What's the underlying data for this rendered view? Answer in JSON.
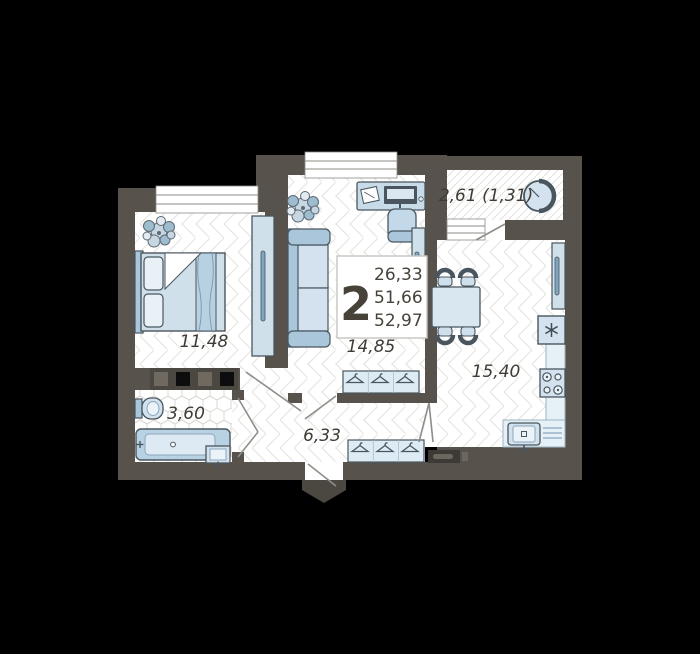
{
  "colors": {
    "background": "#000000",
    "wall": "#57534c",
    "floor": "#ffffff",
    "furniture_light": "#d3e2ee",
    "furniture_mid": "#a9c6da",
    "furniture_deep": "#7fa6c0",
    "outline": "#49565f",
    "label_text": "#3f3b35"
  },
  "summary": {
    "rooms_count": "2",
    "area_lines": [
      "26,33",
      "51,66",
      "52,97"
    ]
  },
  "rooms": [
    {
      "name": "bedroom",
      "area": "11,48"
    },
    {
      "name": "living-room",
      "area": "14,85"
    },
    {
      "name": "kitchen-living",
      "area": "15,40"
    },
    {
      "name": "bathroom",
      "area": "3,60"
    },
    {
      "name": "hallway",
      "area": "6,33"
    },
    {
      "name": "balcony",
      "area": "2,61 (1,31)"
    }
  ]
}
